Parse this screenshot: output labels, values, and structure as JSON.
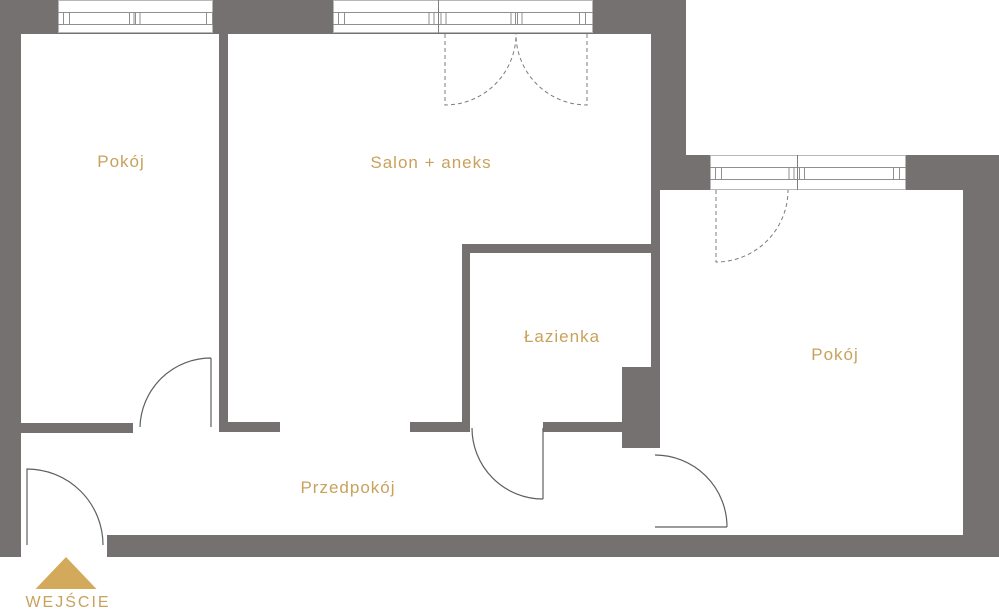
{
  "palette": {
    "wall": "#747170",
    "label_gold": "#c8a25c",
    "triangle_gold": "#d3aa5c",
    "door_line": "#5f5f5f",
    "dashed_door_line": "#7c7c7c",
    "window_line": "#8f8f8f",
    "background": "#ffffff"
  },
  "rooms": [
    {
      "id": "room-left",
      "label": "Pokój"
    },
    {
      "id": "salon",
      "label": "Salon + aneks"
    },
    {
      "id": "bathroom",
      "label": "Łazienka"
    },
    {
      "id": "hallway",
      "label": "Przedpokój"
    },
    {
      "id": "room-right",
      "label": "Pokój"
    }
  ],
  "entrance": {
    "label": "WEJŚCIE",
    "marker_icon": "triangle-up"
  }
}
